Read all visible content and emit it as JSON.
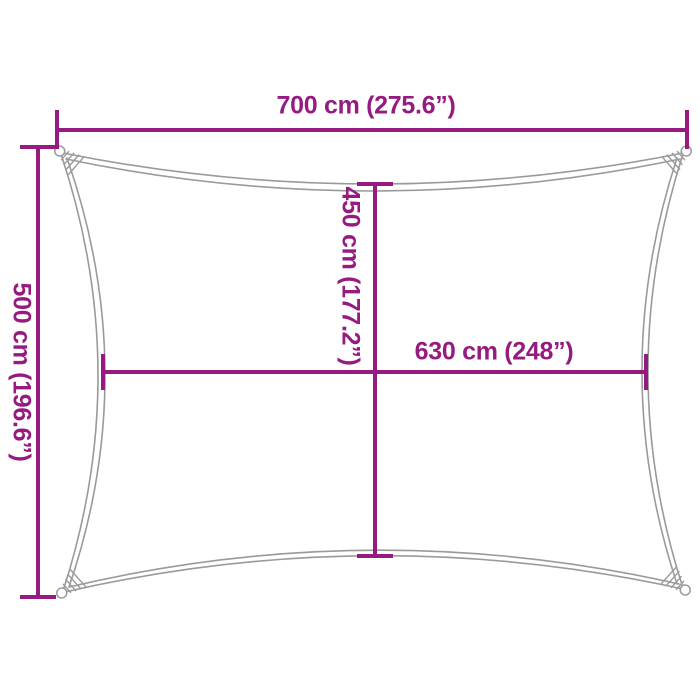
{
  "labels": {
    "top_width": "700 cm (275.6”)",
    "left_height": "500 cm (196.6”)",
    "inner_height": "450 cm (177.2”)",
    "inner_width": "630 cm (248”)"
  },
  "colors": {
    "accent": "#951b81",
    "outline": "#9a9a9a",
    "background": "#ffffff"
  }
}
